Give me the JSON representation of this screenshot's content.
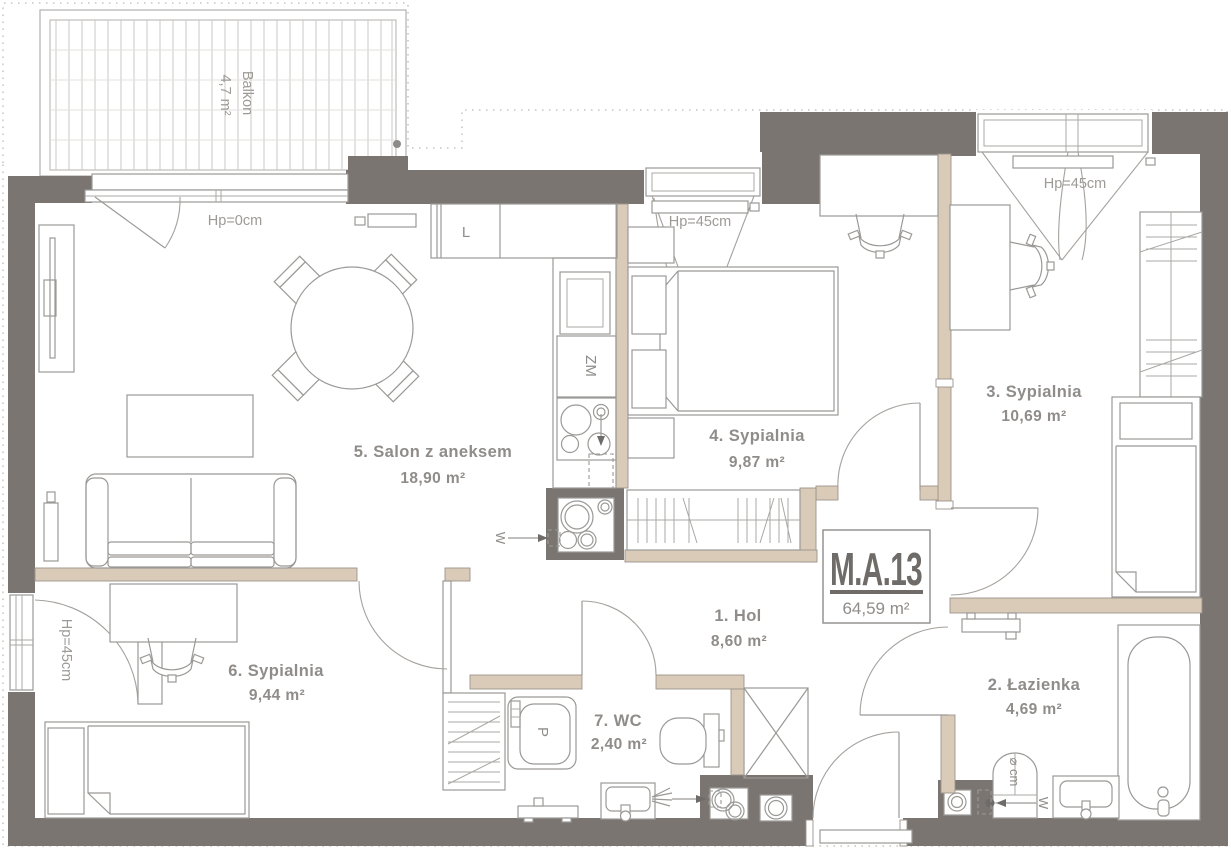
{
  "apartment": {
    "id": "M.A.13",
    "total_area": "64,59 m²"
  },
  "balcony": {
    "name": "Balkon",
    "area": "4,7 m²"
  },
  "rooms": [
    {
      "label": "1. Hol",
      "area": "8,60 m²"
    },
    {
      "label": "2. Łazienka",
      "area": "4,69 m²"
    },
    {
      "label": "3. Sypialnia",
      "area": "10,69 m²"
    },
    {
      "label": "4. Sypialnia",
      "area": "9,87 m²"
    },
    {
      "label": "5. Salon z aneksem",
      "area": "18,90 m²"
    },
    {
      "label": "6. Sypialnia",
      "area": "9,44 m²"
    },
    {
      "label": "7. WC",
      "area": "2,40 m²"
    }
  ],
  "annotations": {
    "hp_0": "Hp=0cm",
    "hp_45": "Hp=45cm",
    "heater_diameter": "⌀ cm",
    "water_supply": "W"
  },
  "appliances": {
    "fridge": "L",
    "dishwasher": "ZM",
    "washing_machine": "P"
  },
  "colors": {
    "wall": "#7b7572",
    "partition": "#d9cbb8",
    "partition_stroke": "#9b948c",
    "furniture_line": "#9a9996",
    "label_text": "#8f8c89",
    "plan_id_text": "#6f6b68"
  }
}
